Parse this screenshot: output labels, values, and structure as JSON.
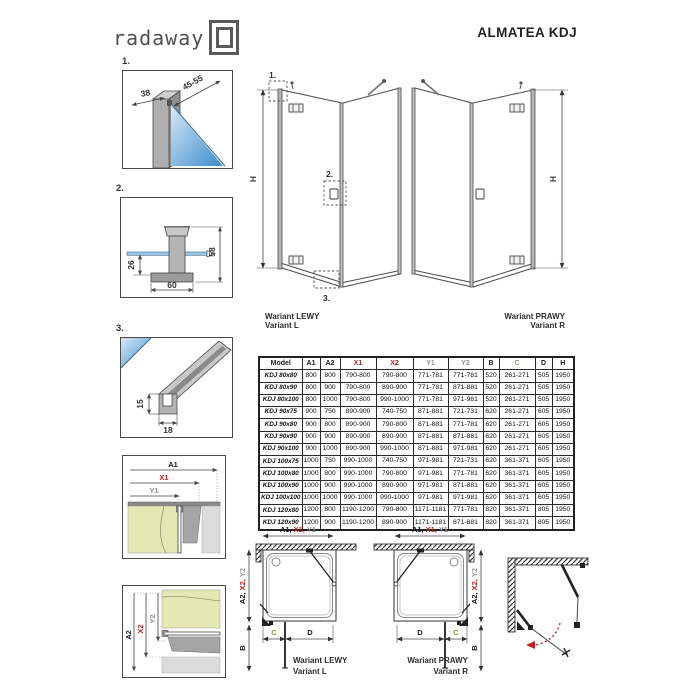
{
  "header": {
    "logo": "radaway",
    "title": "ALMATEA KDJ"
  },
  "details": {
    "d1": {
      "num": "1.",
      "dim_a": "38",
      "dim_b": "45-55"
    },
    "d2": {
      "num": "2.",
      "dim_a": "58",
      "dim_b": "26",
      "dim_c": "60"
    },
    "d3": {
      "num": "3.",
      "dim_a": "15",
      "dim_b": "18"
    }
  },
  "elevations": {
    "h": "H",
    "left": {
      "pl": "Wariant LEWY",
      "en": "Variant L",
      "c1": "1.",
      "c2": "2.",
      "c3": "3."
    },
    "right": {
      "pl": "Wariant PRAWY",
      "en": "Variant R"
    }
  },
  "dims": {
    "a1": "A1",
    "x1": "X1",
    "y1": "Y1",
    "a2": "A2",
    "x2": "X2",
    "y2": "Y2",
    "b": "B",
    "c": "C",
    "d": "D",
    "a1c": "A1,",
    "x1c": "X1,",
    "a2c": "A2,",
    "x2c": "X2,"
  },
  "plans": {
    "left": {
      "pl": "Wariant LEWY",
      "en": "Variant L"
    },
    "right": {
      "pl": "Wariant PRAWY",
      "en": "Variant R"
    }
  },
  "colors": {
    "x1_header": "#9c3232",
    "x2_header": "#c02020",
    "y_header": "#8f8f8f",
    "c_header": "#8a9a63",
    "glass": "#3c8ccc",
    "wall": "#e4e8b2"
  },
  "table": {
    "columns": [
      "Model",
      "A1",
      "A2",
      "X1",
      "X2",
      "Y1",
      "Y2",
      "B",
      "C",
      "D",
      "H"
    ],
    "header_colors": [
      "#1a1a1a",
      "#1a1a1a",
      "#1a1a1a",
      "#9c3232",
      "#c02020",
      "#8f8f8f",
      "#8f8f8f",
      "#1a1a1a",
      "#8a9a63",
      "#1a1a1a",
      "#1a1a1a"
    ],
    "rows": [
      [
        "KDJ 80x80",
        "800",
        "800",
        "790-800",
        "790-800",
        "771-781",
        "771-781",
        "520",
        "261-271",
        "505",
        "1950"
      ],
      [
        "KDJ 80x90",
        "800",
        "900",
        "790-800",
        "890-900",
        "771-781",
        "871-881",
        "520",
        "261-271",
        "505",
        "1950"
      ],
      [
        "KDJ 80x100",
        "800",
        "1000",
        "790-800",
        "990-1000",
        "771-781",
        "971-981",
        "520",
        "261-271",
        "505",
        "1950"
      ],
      [
        "KDJ 90x75",
        "900",
        "750",
        "890-900",
        "740-750",
        "871-881",
        "721-731",
        "620",
        "261-271",
        "605",
        "1950"
      ],
      [
        "KDJ 90x80",
        "900",
        "800",
        "890-900",
        "790-800",
        "871-881",
        "771-781",
        "620",
        "261-271",
        "605",
        "1950"
      ],
      [
        "KDJ 90x90",
        "900",
        "900",
        "890-900",
        "890-900",
        "871-881",
        "871-881",
        "620",
        "261-271",
        "605",
        "1950"
      ],
      [
        "KDJ 90x100",
        "900",
        "1000",
        "890-900",
        "990-1000",
        "871-881",
        "971-981",
        "620",
        "261-271",
        "605",
        "1950"
      ],
      [
        "KDJ 100x75",
        "1000",
        "750",
        "990-1000",
        "740-750",
        "971-981",
        "721-731",
        "620",
        "361-371",
        "605",
        "1950"
      ],
      [
        "KDJ 100x80",
        "1000",
        "800",
        "990-1000",
        "790-800",
        "971-981",
        "771-781",
        "620",
        "361-371",
        "605",
        "1950"
      ],
      [
        "KDJ 100x90",
        "1000",
        "900",
        "990-1000",
        "890-900",
        "971-981",
        "871-881",
        "620",
        "361-371",
        "605",
        "1950"
      ],
      [
        "KDJ 100x100",
        "1000",
        "1000",
        "990-1000",
        "990-1000",
        "971-981",
        "971-981",
        "620",
        "361-371",
        "605",
        "1950"
      ],
      [
        "KDJ 120x80",
        "1200",
        "800",
        "1190-1200",
        "790-800",
        "1171-1181",
        "771-781",
        "820",
        "361-371",
        "805",
        "1950"
      ],
      [
        "KDJ 120x90",
        "1200",
        "900",
        "1190-1200",
        "890-900",
        "1171-1181",
        "871-881",
        "820",
        "361-371",
        "805",
        "1950"
      ]
    ]
  }
}
